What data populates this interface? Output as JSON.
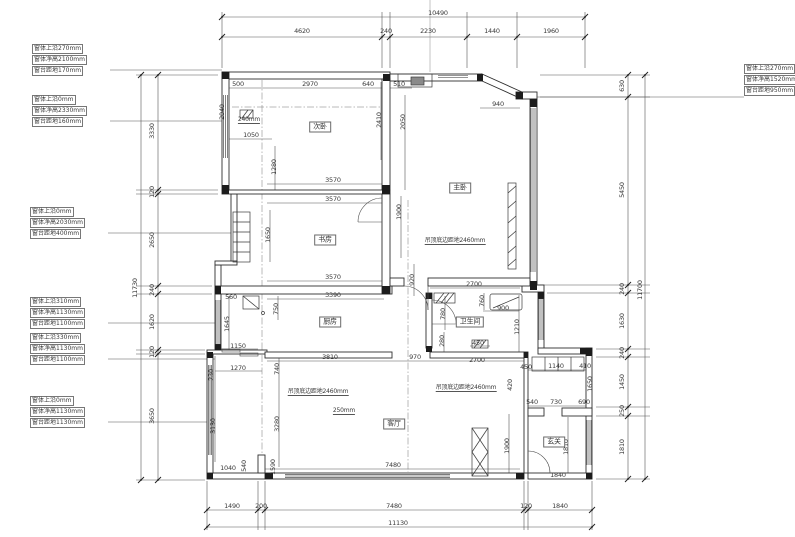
{
  "drawing_type": "apartment floor plan (CAD construction drawing)",
  "colors": {
    "background": "#ffffff",
    "wall_line": "#2f2f2f",
    "dim_line": "#555555",
    "text": "#3a3a3a"
  },
  "dim_chains": {
    "top": {
      "total": "10490",
      "segments": [
        "4620",
        "240",
        "2230",
        "1440",
        "1960"
      ]
    },
    "bottom": {
      "total": "11130",
      "segments": [
        "1490",
        "200",
        "7480",
        "120",
        "1840"
      ]
    },
    "left": {
      "total": "11730",
      "segments": [
        "3330",
        "120",
        "2650",
        "240",
        "1620",
        "120",
        "3650"
      ]
    },
    "right": {
      "total": "11700",
      "segments": [
        "630",
        "5450",
        "240",
        "1630",
        "240",
        "1450",
        "250",
        "1810"
      ]
    }
  },
  "rooms": [
    {
      "name": "次卧",
      "x": 320,
      "y": 127
    },
    {
      "name": "主卧",
      "x": 460,
      "y": 188
    },
    {
      "name": "书房",
      "x": 325,
      "y": 240
    },
    {
      "name": "厨房",
      "x": 330,
      "y": 322
    },
    {
      "name": "卫生间",
      "x": 470,
      "y": 322
    },
    {
      "name": "客厅",
      "x": 394,
      "y": 424
    },
    {
      "name": "玄关",
      "x": 554,
      "y": 442
    }
  ],
  "ceiling_notes": [
    {
      "text": "吊顶底边距地2460mm",
      "x": 455,
      "y": 245
    },
    {
      "text": "吊顶底边距地2460mm",
      "x": 318,
      "y": 396
    },
    {
      "text": "吊顶底边距地2460mm",
      "x": 466,
      "y": 392
    }
  ],
  "small_notes": [
    {
      "text": "250mm",
      "x": 344,
      "y": 415
    },
    {
      "text": "240mm",
      "x": 249,
      "y": 124
    }
  ],
  "window_notes": [
    {
      "x": 32,
      "y": 44,
      "lines": [
        "窗体上沿270mm",
        "窗体净高2100mm",
        "窗台距地170mm"
      ]
    },
    {
      "x": 32,
      "y": 95,
      "lines": [
        "窗体上沿0mm",
        "窗体净高2330mm",
        "窗台距地160mm"
      ]
    },
    {
      "x": 30,
      "y": 207,
      "lines": [
        "窗体上沿0mm",
        "窗体净高2030mm",
        "窗台距地400mm"
      ]
    },
    {
      "x": 30,
      "y": 297,
      "lines": [
        "窗体上沿310mm",
        "窗体净高1130mm",
        "窗台距地1100mm"
      ]
    },
    {
      "x": 30,
      "y": 333,
      "lines": [
        "窗体上沿330mm",
        "窗体净高1130mm",
        "窗台距地1100mm"
      ]
    },
    {
      "x": 30,
      "y": 396,
      "lines": [
        "窗体上沿0mm",
        "窗体净高1130mm",
        "窗台距地1130mm"
      ]
    },
    {
      "x": 744,
      "y": 64,
      "lines": [
        "窗体上沿270mm",
        "窗体净高1520mm",
        "窗台距地950mm"
      ]
    }
  ],
  "labels": [
    {
      "t": "10490",
      "x": 438,
      "y": 13
    },
    {
      "t": "4620",
      "x": 302,
      "y": 31
    },
    {
      "t": "240",
      "x": 386,
      "y": 31
    },
    {
      "t": "2230",
      "x": 428,
      "y": 31
    },
    {
      "t": "1440",
      "x": 492,
      "y": 31
    },
    {
      "t": "1960",
      "x": 551,
      "y": 31
    },
    {
      "t": "1490",
      "x": 232,
      "y": 506
    },
    {
      "t": "200",
      "x": 261,
      "y": 506
    },
    {
      "t": "7480",
      "x": 394,
      "y": 506
    },
    {
      "t": "120",
      "x": 526,
      "y": 506
    },
    {
      "t": "1840",
      "x": 560,
      "y": 506
    },
    {
      "t": "11130",
      "x": 398,
      "y": 523
    },
    {
      "t": "3330",
      "x": 152,
      "y": 131,
      "r": 1
    },
    {
      "t": "120",
      "x": 152,
      "y": 192,
      "r": 1
    },
    {
      "t": "2650",
      "x": 152,
      "y": 240,
      "r": 1
    },
    {
      "t": "240",
      "x": 152,
      "y": 290,
      "r": 1
    },
    {
      "t": "1620",
      "x": 152,
      "y": 322,
      "r": 1
    },
    {
      "t": "120",
      "x": 152,
      "y": 352,
      "r": 1
    },
    {
      "t": "3650",
      "x": 152,
      "y": 416,
      "r": 1
    },
    {
      "t": "11730",
      "x": 135,
      "y": 288,
      "r": 1
    },
    {
      "t": "630",
      "x": 622,
      "y": 86,
      "r": 1
    },
    {
      "t": "5450",
      "x": 622,
      "y": 190,
      "r": 1
    },
    {
      "t": "240",
      "x": 622,
      "y": 289,
      "r": 1
    },
    {
      "t": "1630",
      "x": 622,
      "y": 321,
      "r": 1
    },
    {
      "t": "240",
      "x": 622,
      "y": 353,
      "r": 1
    },
    {
      "t": "1450",
      "x": 622,
      "y": 382,
      "r": 1
    },
    {
      "t": "250",
      "x": 622,
      "y": 411,
      "r": 1
    },
    {
      "t": "1810",
      "x": 622,
      "y": 447,
      "r": 1
    },
    {
      "t": "11700",
      "x": 640,
      "y": 290,
      "r": 1
    },
    {
      "t": "500",
      "x": 238,
      "y": 84
    },
    {
      "t": "2970",
      "x": 310,
      "y": 84
    },
    {
      "t": "640",
      "x": 368,
      "y": 84
    },
    {
      "t": "510",
      "x": 399,
      "y": 84
    },
    {
      "t": "940",
      "x": 498,
      "y": 104
    },
    {
      "t": "2040",
      "x": 222,
      "y": 112,
      "r": 1
    },
    {
      "t": "1050",
      "x": 251,
      "y": 135
    },
    {
      "t": "2410",
      "x": 379,
      "y": 120,
      "r": 1
    },
    {
      "t": "2050",
      "x": 403,
      "y": 122,
      "r": 1
    },
    {
      "t": "1280",
      "x": 274,
      "y": 167,
      "r": 1
    },
    {
      "t": "3570",
      "x": 333,
      "y": 180
    },
    {
      "t": "3570",
      "x": 333,
      "y": 199
    },
    {
      "t": "1900",
      "x": 399,
      "y": 212,
      "r": 1
    },
    {
      "t": "1650",
      "x": 268,
      "y": 235,
      "r": 1
    },
    {
      "t": "3570",
      "x": 333,
      "y": 277
    },
    {
      "t": "920",
      "x": 412,
      "y": 280,
      "r": 1
    },
    {
      "t": "2700",
      "x": 474,
      "y": 284
    },
    {
      "t": "3390",
      "x": 333,
      "y": 295
    },
    {
      "t": "560",
      "x": 231,
      "y": 297
    },
    {
      "t": "750",
      "x": 276,
      "y": 309,
      "r": 1
    },
    {
      "t": "780",
      "x": 443,
      "y": 314,
      "r": 1
    },
    {
      "t": "760",
      "x": 482,
      "y": 301,
      "r": 1
    },
    {
      "t": "900",
      "x": 503,
      "y": 308
    },
    {
      "t": "1210",
      "x": 517,
      "y": 327,
      "r": 1
    },
    {
      "t": "280",
      "x": 442,
      "y": 341,
      "r": 1
    },
    {
      "t": "450",
      "x": 478,
      "y": 343
    },
    {
      "t": "1645",
      "x": 227,
      "y": 324,
      "r": 1
    },
    {
      "t": "1150",
      "x": 238,
      "y": 346
    },
    {
      "t": "1270",
      "x": 238,
      "y": 368
    },
    {
      "t": "740",
      "x": 277,
      "y": 369,
      "r": 1
    },
    {
      "t": "230",
      "x": 211,
      "y": 375,
      "r": 1
    },
    {
      "t": "3810",
      "x": 330,
      "y": 357
    },
    {
      "t": "970",
      "x": 415,
      "y": 357
    },
    {
      "t": "2700",
      "x": 477,
      "y": 360
    },
    {
      "t": "3130",
      "x": 213,
      "y": 426,
      "r": 1
    },
    {
      "t": "3280",
      "x": 277,
      "y": 424,
      "r": 1
    },
    {
      "t": "1040",
      "x": 228,
      "y": 468
    },
    {
      "t": "540",
      "x": 244,
      "y": 466,
      "r": 1
    },
    {
      "t": "1590",
      "x": 273,
      "y": 467,
      "r": 1
    },
    {
      "t": "7480",
      "x": 393,
      "y": 465
    },
    {
      "t": "450",
      "x": 526,
      "y": 367
    },
    {
      "t": "1140",
      "x": 556,
      "y": 366
    },
    {
      "t": "410",
      "x": 585,
      "y": 366
    },
    {
      "t": "420",
      "x": 510,
      "y": 385,
      "r": 1
    },
    {
      "t": "540",
      "x": 532,
      "y": 402
    },
    {
      "t": "730",
      "x": 556,
      "y": 402
    },
    {
      "t": "690",
      "x": 584,
      "y": 402
    },
    {
      "t": "1650",
      "x": 590,
      "y": 384,
      "r": 1
    },
    {
      "t": "1900",
      "x": 507,
      "y": 446,
      "r": 1
    },
    {
      "t": "1810",
      "x": 566,
      "y": 447,
      "r": 1
    },
    {
      "t": "1840",
      "x": 558,
      "y": 475
    }
  ]
}
